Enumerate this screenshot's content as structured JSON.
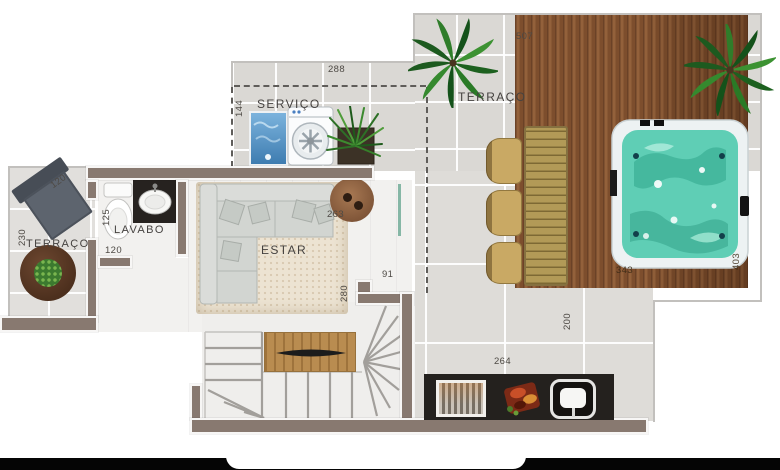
{
  "floor_plan": {
    "rooms": {
      "terraco_top": "TERRAÇO",
      "servico": "SERVIÇO",
      "terraco_left": "TERRAÇO",
      "lavabo": "LAVABO",
      "estar": "ESTAR"
    },
    "dimensions": {
      "servico_width": "288",
      "servico_depth": "144",
      "terraco_top_width": "507",
      "terraco_left_width": "120",
      "terraco_left_depth": "230",
      "lavabo_depth": "125",
      "lavabo_width": "120",
      "estar_side_table": "263",
      "passage_width": "91",
      "estar_depth": "280",
      "terraco_right_depth": "200",
      "churrasqueira_width": "264",
      "deck_width": "343",
      "deck_depth": "403"
    },
    "colors": {
      "wall": "#887970",
      "tile": "#dad8d4",
      "deck_wood": "#8a5835",
      "spa_water": "#5fceb5",
      "counter_dark": "#24211e",
      "rug": "#ece3d2",
      "plant_green": "#3c7a2f",
      "dashed_line": "#5f5d5a"
    }
  }
}
